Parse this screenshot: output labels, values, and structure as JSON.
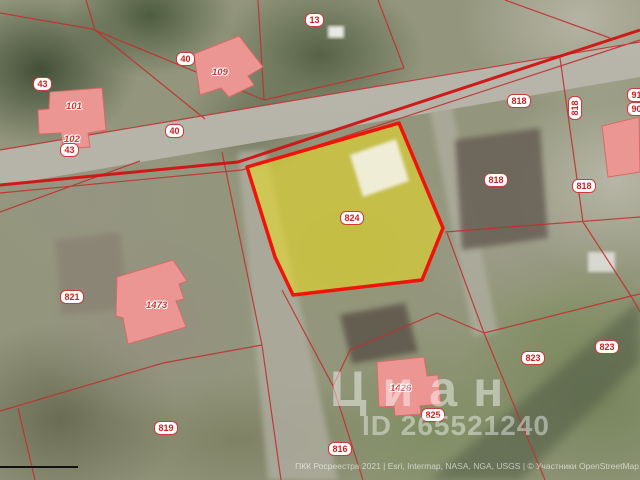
{
  "map": {
    "watermark": {
      "brand": "Циан",
      "id_text": "ID 265521240"
    },
    "attribution": {
      "text": "ПКК Росреестра 2021 | Esri, Intermap, NASA, NGA, USGS | © Участники OpenStreetMap"
    },
    "selected_parcel": {
      "label": "824"
    },
    "colors": {
      "parcel_line": "#c03030",
      "road_line": "#d01212",
      "highlight_fill": "#e8da24",
      "highlight_border": "#f01408",
      "building_fill": "#ec9694",
      "label_text": "#cc2222"
    }
  },
  "labels": {
    "parcels": [
      {
        "text": "43"
      },
      {
        "text": "40"
      },
      {
        "text": "13"
      },
      {
        "text": "40"
      },
      {
        "text": "43"
      },
      {
        "text": "818"
      },
      {
        "text": "818",
        "rotated": true
      },
      {
        "text": "818"
      },
      {
        "text": "818"
      },
      {
        "text": "91"
      },
      {
        "text": "90"
      },
      {
        "text": "821"
      },
      {
        "text": "824"
      },
      {
        "text": "819"
      },
      {
        "text": "816"
      },
      {
        "text": "825"
      },
      {
        "text": "823"
      },
      {
        "text": "823"
      }
    ],
    "buildings": [
      {
        "text": "101"
      },
      {
        "text": "102"
      },
      {
        "text": "109"
      },
      {
        "text": "1473"
      },
      {
        "text": "1426"
      }
    ]
  }
}
